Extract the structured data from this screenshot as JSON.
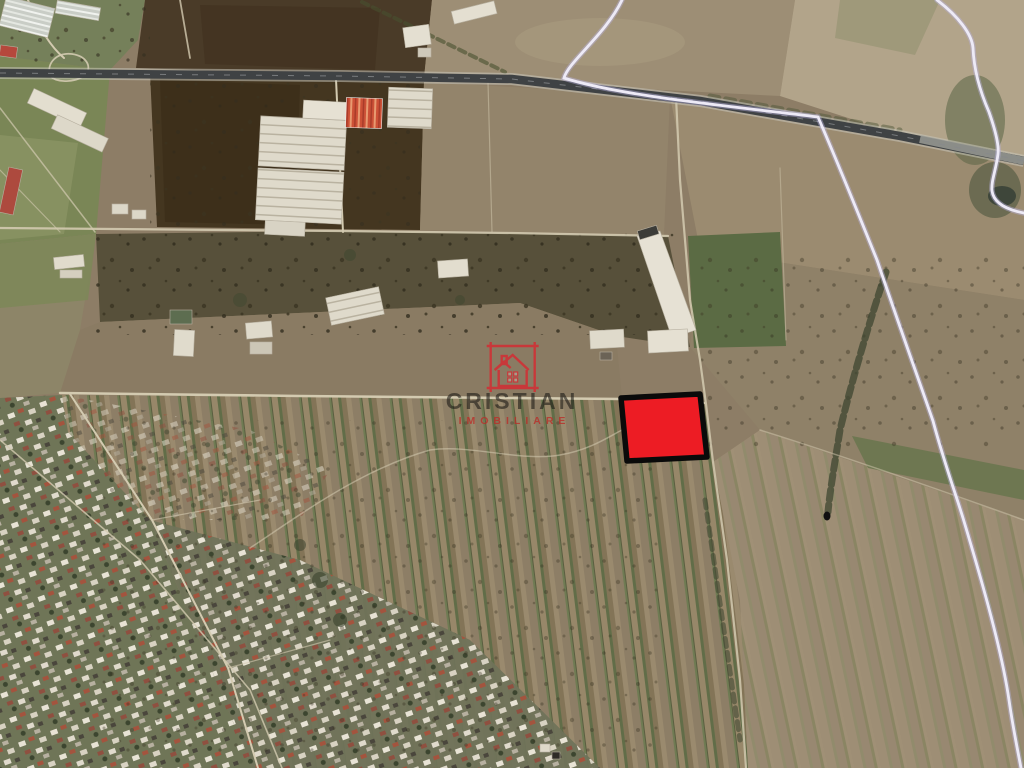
{
  "watermark": {
    "brand": "CRISTIAN",
    "tagline": "IMOBILIARE",
    "logo_icon": "house-in-square-icon"
  },
  "map": {
    "kind": "satellite-aerial-photo",
    "highlighted_parcel": {
      "shape": "quadrilateral",
      "fill": "#ed1c24",
      "outline": "#000000"
    }
  },
  "colors": {
    "parcel_fill": "#ed1c24",
    "parcel_outline": "#0a0a0a",
    "route_line": "#edeaf6",
    "route_halo": "#b9b2dd",
    "highway": "#3f4244",
    "road": "#d3cab0",
    "logo_red": "#d12f35",
    "brand_text": "#1a1814",
    "tagline_red": "#b9302a"
  }
}
